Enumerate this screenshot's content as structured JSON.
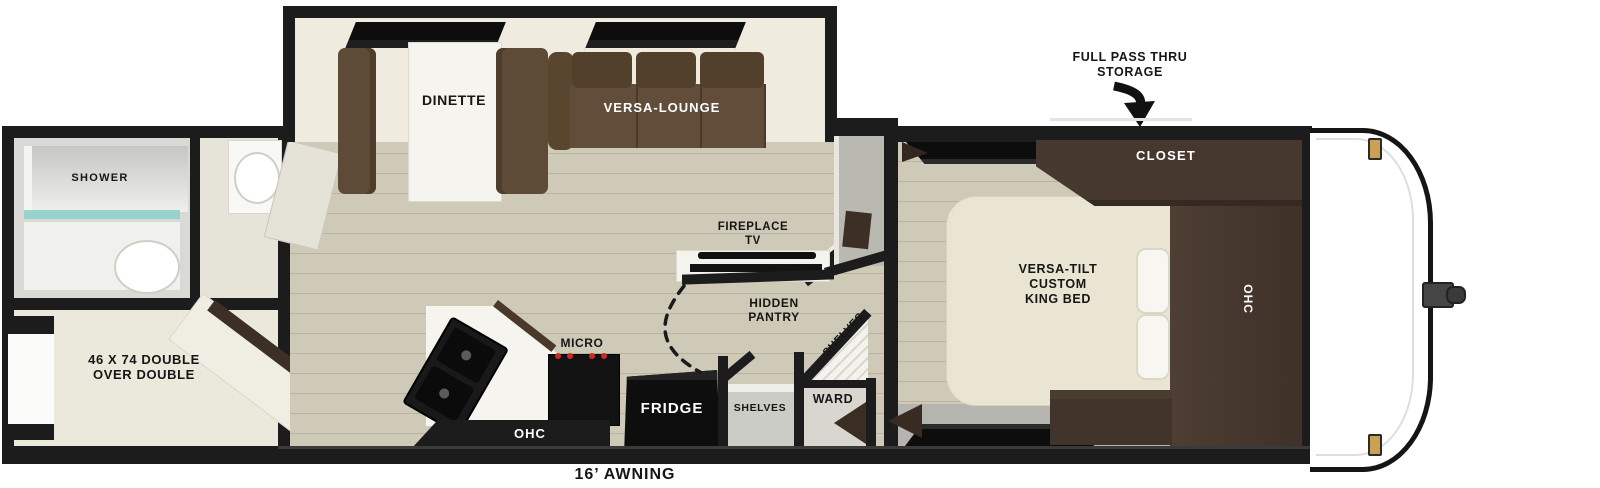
{
  "plan": {
    "rear": {
      "shower": "SHOWER",
      "bunk_line1": "46 X 74 DOUBLE",
      "bunk_line2": "OVER DOUBLE"
    },
    "slide": {
      "dinette": "DINETTE",
      "lounge": "VERSA-LOUNGE"
    },
    "living": {
      "fireplace_line1": "FIREPLACE",
      "fireplace_line2": "TV"
    },
    "kitchen": {
      "micro": "MICRO",
      "fridge": "FRIDGE",
      "ohc": "OHC"
    },
    "pantry": {
      "line1": "HIDDEN",
      "line2": "PANTRY",
      "shelves_corner": "SHELVES",
      "shelves_closet": "SHELVES",
      "ward": "WARD"
    },
    "bedroom": {
      "closet": "CLOSET",
      "ohc": "OHC",
      "bed_line1": "VERSA-TILT",
      "bed_line2": "CUSTOM",
      "bed_line3": "KING BED"
    },
    "exterior": {
      "storage_line1": "FULL PASS THRU",
      "storage_line2": "STORAGE",
      "awning": "16’ AWNING"
    }
  },
  "colors": {
    "wall": "#1c1c1c",
    "window": "#0d0d0d",
    "floor": "#cfc9b7",
    "floor_line": "#b9b3a1",
    "sofa": "#5d4a37",
    "sofa_dark": "#52402c",
    "cabinet": "#46382e",
    "cabinet_dark": "#382c23",
    "bed": "#e9e5d2",
    "counter": "#f6f4ee",
    "glass": "#8fd0cb",
    "gold": "#c9a254",
    "gray_floor": "#b5b4ae",
    "gray_wallface": "#b9b8b1"
  }
}
